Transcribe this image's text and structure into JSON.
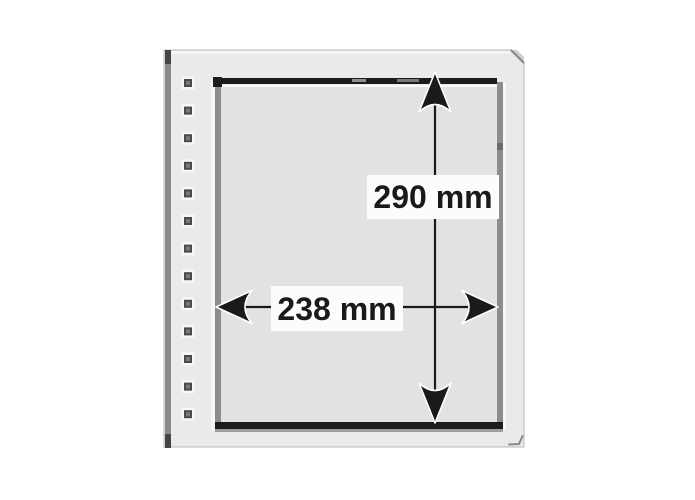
{
  "figure": {
    "title": "Binder pocket sheet with punch holes and outer dimensions",
    "height_label": "290 mm",
    "width_label": "238 mm",
    "holes": {
      "count": 13,
      "cx": 188,
      "start_y": 83,
      "spacing": 27.6,
      "outer_size": 13,
      "ring_size": 8,
      "core_size": 4
    },
    "colors": {
      "background": "#ffffff",
      "sheet": "#eaeaea",
      "sheet_edge": "#b8b8b8",
      "sheet_highlight": "#f4f4f4",
      "left_edge_strip": "#888888",
      "left_edge_caps": "#454545",
      "pocket_interior": "#e2e2e2",
      "pocket_border": "#8d8d8d",
      "seal_strip": "#1c1c1c",
      "strip_reflection": "#8f8f8f",
      "bottom_shadow": "#9e9e9e",
      "fold_corner": "#a8a8a8",
      "dimension_line": "#1a1a1a",
      "label_background": "#fcfcfc",
      "hole_halo": "#f7f7f7",
      "hole_ring": "#4a4a4a",
      "hole_core": "#7a7a7a"
    }
  }
}
